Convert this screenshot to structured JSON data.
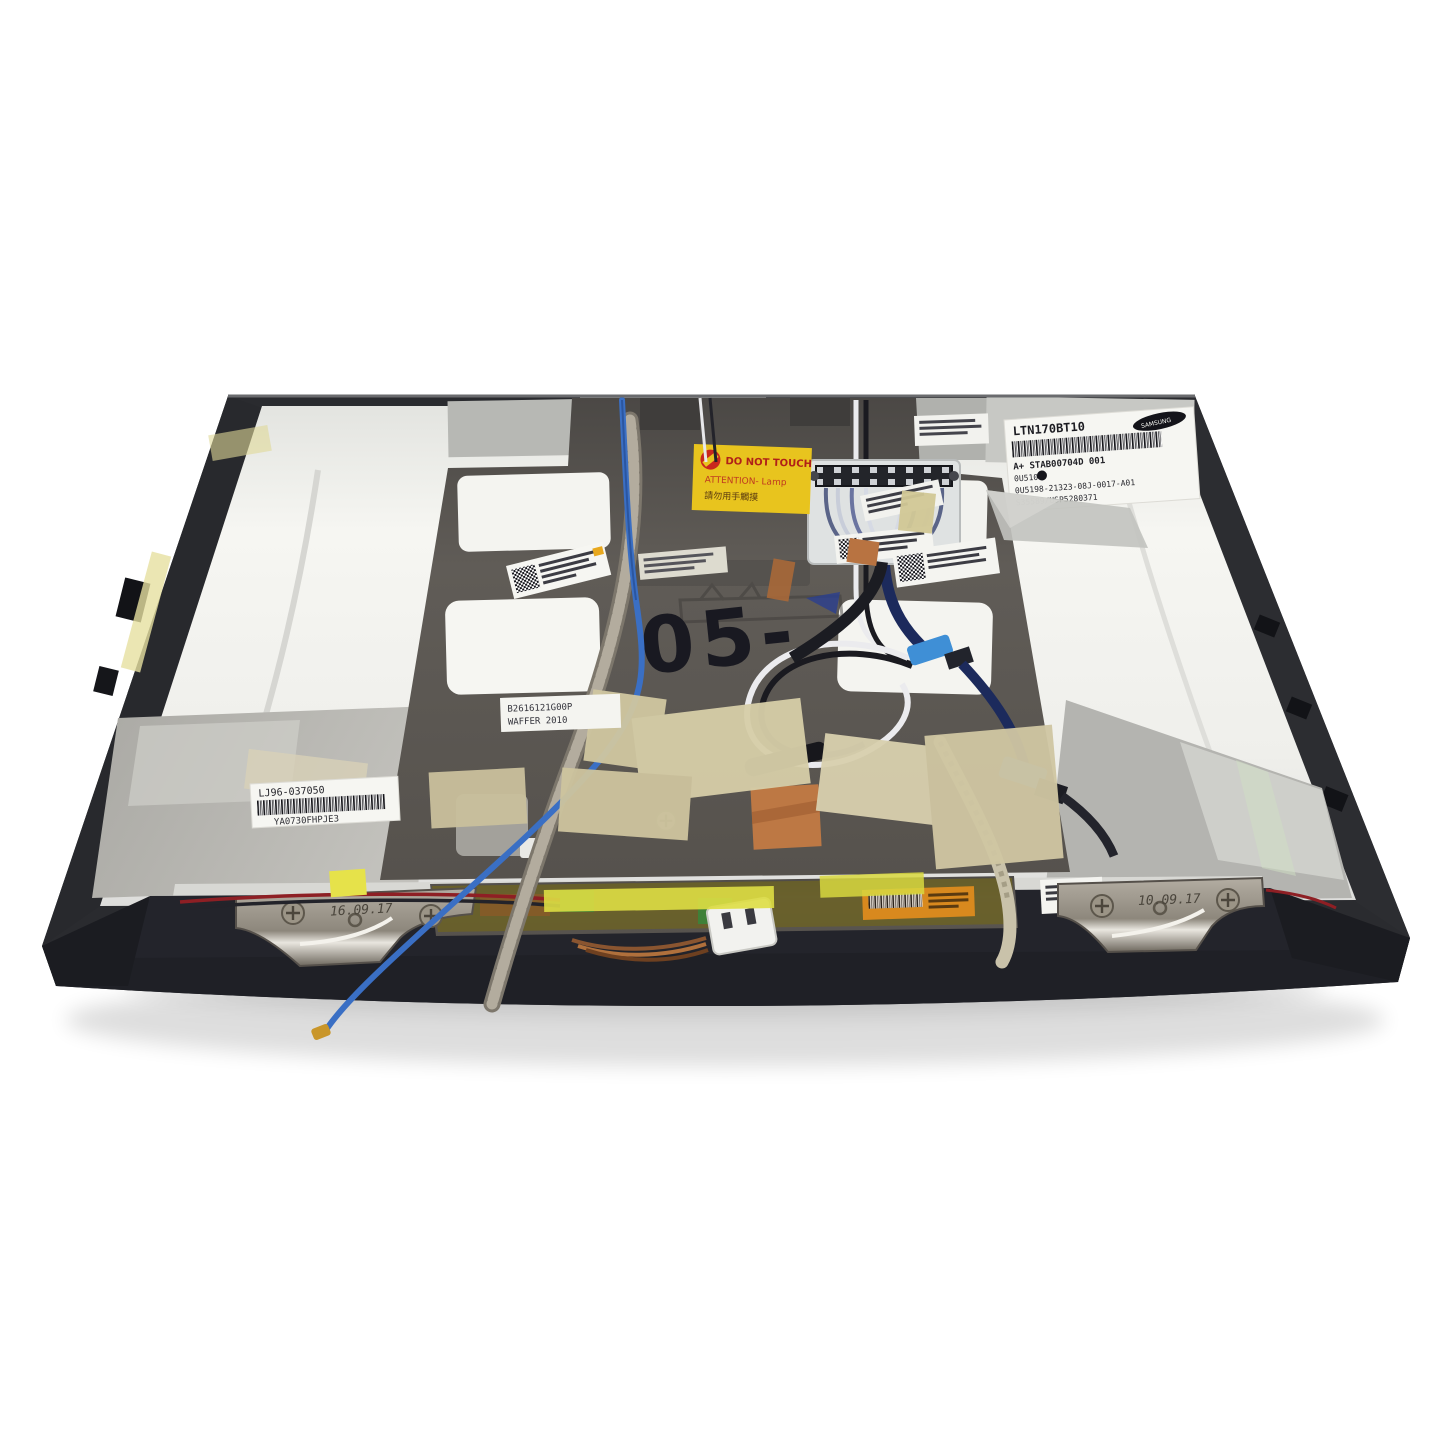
{
  "scene": {
    "type": "product-photo",
    "subject": "Rear view of a 17-inch laptop LCD screen lid assembly (Samsung LTN170BT10) with protective cover, taped cables, hinges and inverter board on a white background",
    "background_color": "#ffffff"
  },
  "colors": {
    "bezel_dark": "#2a2b2f",
    "panel_silver": "#f2f2ee",
    "cover_gray": "#5b5753",
    "masking_tape": "#d3c9a4",
    "copper_tape": "#b87341",
    "warning_yellow": "#e8c41e",
    "antenna_blue": "#3a6fc4",
    "hinge_metal": "#9a948a",
    "inverter_olive": "#6b6226"
  },
  "labels": {
    "samsung": {
      "model": "LTN170BT10",
      "brand": "SAMSUNG",
      "line_a": "A+ STAB00704D   001",
      "line_b": "0U510",
      "line_c": "0U5198-21323-08J-0017-A01",
      "line_d": "S35589/USP5280371"
    },
    "warning": {
      "line1": "DO NOT TOUCH",
      "line2": "ATTENTION- Lamp",
      "line3": "請勿用手觸摸"
    },
    "lj96": {
      "line1": "LJ96-037050",
      "line2": "YA0730FHPJE3"
    },
    "waffer": {
      "line1": "B2616121G00P",
      "line2": "WAFFER 2010"
    },
    "hinge_left_stamp": "16.09.17",
    "hinge_right_stamp": "10.09.17",
    "handwritten_mark": "05-"
  }
}
